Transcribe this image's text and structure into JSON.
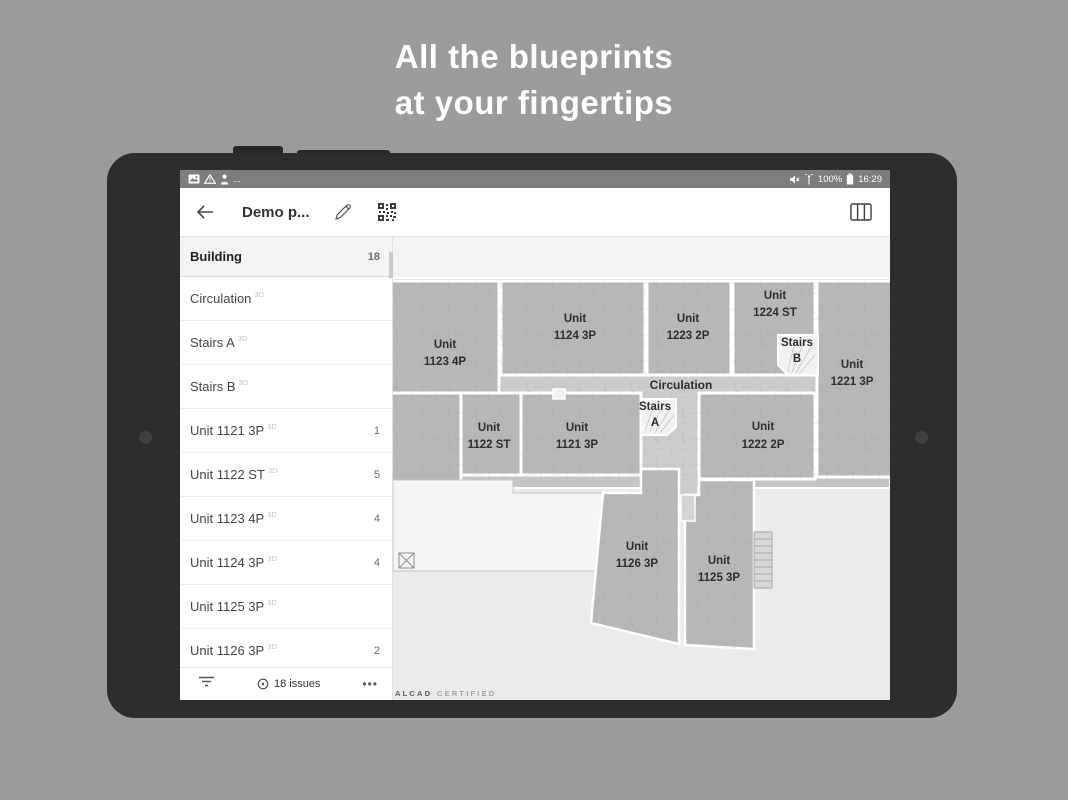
{
  "hero": {
    "line1": "All the blueprints",
    "line2": "at your fingertips"
  },
  "status_bar": {
    "ellipsis": "...",
    "battery_pct": "100%",
    "time": "16:29"
  },
  "app_bar": {
    "back": "back-arrow",
    "title": "Demo p..."
  },
  "sidebar": {
    "items": [
      {
        "label": "Building",
        "tag": "",
        "count": "18",
        "selected": true
      },
      {
        "label": "Circulation",
        "tag": "3D",
        "count": ""
      },
      {
        "label": "Stairs A",
        "tag": "3D",
        "count": ""
      },
      {
        "label": "Stairs B",
        "tag": "3D",
        "count": ""
      },
      {
        "label": "Unit 1121 3P",
        "tag": "3D",
        "count": "1"
      },
      {
        "label": "Unit 1122 ST",
        "tag": "3D",
        "count": "5"
      },
      {
        "label": "Unit 1123 4P",
        "tag": "3D",
        "count": "4"
      },
      {
        "label": "Unit 1124 3P",
        "tag": "3D",
        "count": "4"
      },
      {
        "label": "Unit 1125 3P",
        "tag": "3D",
        "count": ""
      },
      {
        "label": "Unit 1126 3P",
        "tag": "3D",
        "count": "2"
      }
    ]
  },
  "bottom_bar": {
    "issues": "18 issues",
    "more": "•••"
  },
  "plan": {
    "labels": {
      "u1123": {
        "l1": "Unit",
        "l2": "1123 4P"
      },
      "u1124": {
        "l1": "Unit",
        "l2": "1124 3P"
      },
      "u1223": {
        "l1": "Unit",
        "l2": "1223 2P"
      },
      "u1224": {
        "l1": "Unit",
        "l2": "1224 ST"
      },
      "stairs_b": {
        "l1": "Stairs",
        "l2": "B"
      },
      "u1221": {
        "l1": "Unit",
        "l2": "1221 3P"
      },
      "circulation": "Circulation",
      "u1122": {
        "l1": "Unit",
        "l2": "1122 ST"
      },
      "u1121": {
        "l1": "Unit",
        "l2": "1121 3P"
      },
      "stairs_a": {
        "l1": "Stairs",
        "l2": "A"
      },
      "u1222": {
        "l1": "Unit",
        "l2": "1222 2P"
      },
      "u1126": {
        "l1": "Unit",
        "l2": "1126 3P"
      },
      "u1125": {
        "l1": "Unit",
        "l2": "1125 3P"
      }
    },
    "watermark": {
      "brand": "ALCAD",
      "suffix": "CERTIFIED"
    }
  },
  "colors": {
    "page_bg": "#9b9b9b",
    "tablet_frame": "#2d2d2d",
    "status_bar": "#7d7d7d",
    "unit_fill": "#b8b7b5",
    "corridor_fill": "#cdccca",
    "selected_row_bg": "#f4f4f4"
  }
}
